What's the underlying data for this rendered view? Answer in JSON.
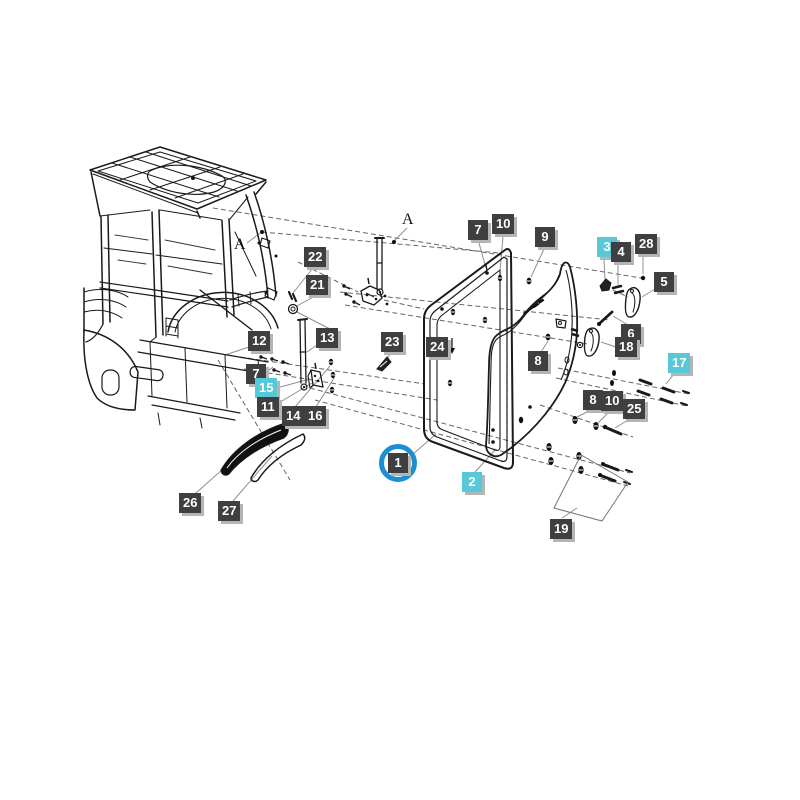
{
  "diagram": {
    "type": "exploded-parts-diagram",
    "subject": "tractor cab door assembly",
    "background": "#ffffff",
    "line_color": "#1a1a1a",
    "label_style": {
      "dark_bg": "#3f3f41",
      "cyan_bg": "#56c8d8",
      "text_color": "#ffffff",
      "shadow": "#b5b5b5"
    },
    "selection": {
      "selected_part": "1",
      "ring_color": "#1b8fd2",
      "cyan_labels": [
        "15",
        "2",
        "3",
        "17"
      ]
    },
    "annotations": [
      {
        "text": "A"
      },
      {
        "text": "A"
      }
    ],
    "labels": [
      {
        "text": "22",
        "variant": "dark"
      },
      {
        "text": "21",
        "variant": "dark"
      },
      {
        "text": "12",
        "variant": "dark"
      },
      {
        "text": "13",
        "variant": "dark"
      },
      {
        "text": "23",
        "variant": "dark"
      },
      {
        "text": "24",
        "variant": "dark"
      },
      {
        "text": "7",
        "variant": "dark"
      },
      {
        "text": "15",
        "variant": "cyan"
      },
      {
        "text": "11",
        "variant": "dark"
      },
      {
        "text": "14",
        "variant": "dark"
      },
      {
        "text": "16",
        "variant": "dark"
      },
      {
        "text": "26",
        "variant": "dark"
      },
      {
        "text": "27",
        "variant": "dark"
      },
      {
        "text": "1",
        "variant": "dark-selected"
      },
      {
        "text": "2",
        "variant": "cyan"
      },
      {
        "text": "19",
        "variant": "dark"
      },
      {
        "text": "7",
        "variant": "dark"
      },
      {
        "text": "10",
        "variant": "dark"
      },
      {
        "text": "9",
        "variant": "dark"
      },
      {
        "text": "3",
        "variant": "cyan"
      },
      {
        "text": "4",
        "variant": "dark"
      },
      {
        "text": "28",
        "variant": "dark"
      },
      {
        "text": "5",
        "variant": "dark"
      },
      {
        "text": "6",
        "variant": "dark"
      },
      {
        "text": "18",
        "variant": "dark"
      },
      {
        "text": "8",
        "variant": "dark"
      },
      {
        "text": "17",
        "variant": "cyan"
      },
      {
        "text": "8",
        "variant": "dark"
      },
      {
        "text": "10",
        "variant": "dark"
      },
      {
        "text": "25",
        "variant": "dark"
      }
    ]
  }
}
